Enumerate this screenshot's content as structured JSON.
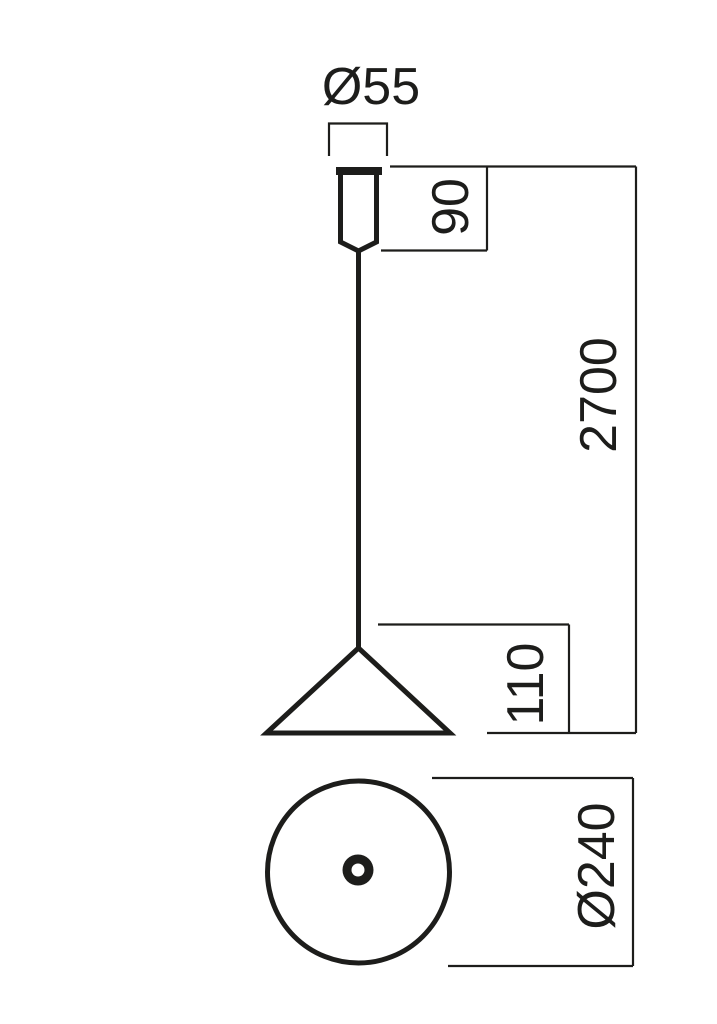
{
  "drawing": {
    "line_color": "#1d1d1b",
    "background_color": "#ffffff",
    "labels": {
      "canopy_diameter": "Ø55",
      "canopy_height": "90",
      "suspension_length": "2700",
      "shade_height": "110",
      "shade_diameter": "Ø240"
    }
  }
}
